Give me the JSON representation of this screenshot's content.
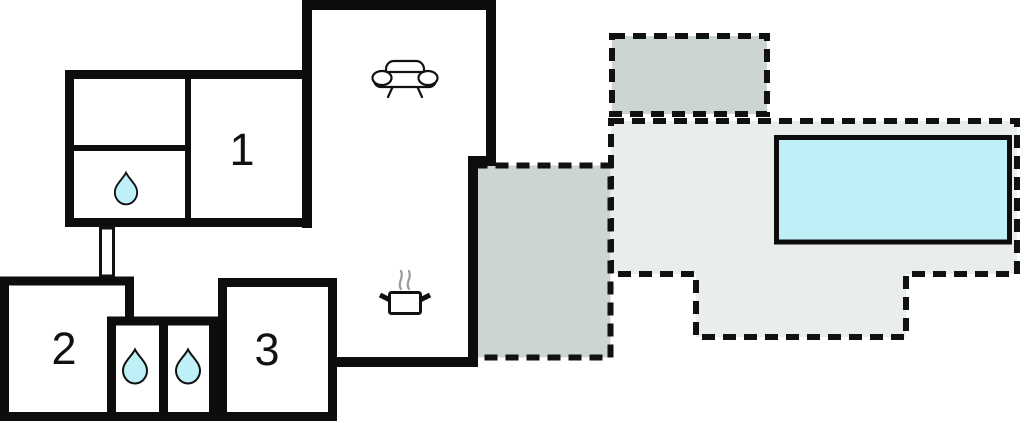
{
  "plan": {
    "rooms": [
      {
        "label": "1"
      },
      {
        "label": "2"
      },
      {
        "label": "3"
      }
    ],
    "icons": {
      "living_room": "sofa-icon",
      "kitchen": "stove-icon",
      "bathroom": "water-drop-icon"
    },
    "colors": {
      "background": "#ffffff",
      "wall": "#0d0d0d",
      "terrace_dark": "#ccd4d4",
      "terrace_light": "#e9eeed",
      "water": "#bdf1f7",
      "steam": "#9a9a9a"
    }
  }
}
